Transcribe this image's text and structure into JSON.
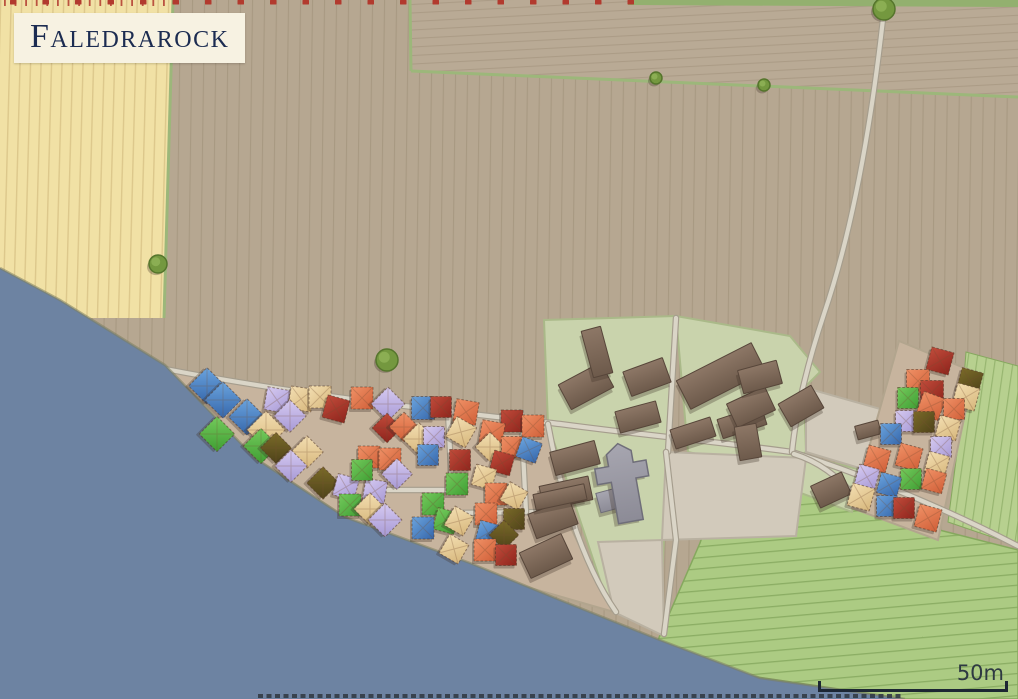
{
  "title": {
    "text": "Faledrarock"
  },
  "scale_bar": {
    "label": "50m"
  },
  "palette": {
    "water": "#6d83a2",
    "shore_edge": "rgba(125,128,95,0.55)",
    "field_brown": "#b6a791",
    "field_brown_line": "#9c8d77",
    "field_brown2": "#b9aa95",
    "field_brown2_line": "#a08f79",
    "field_yellow": "#f1e1a5",
    "field_yellow_line": "#d5bf82",
    "border_green": "#9cb77a",
    "top_strip_green": "#93b06f",
    "field_green": "#accb83",
    "field_green_line": "#85a85e",
    "field_green2": "#b7d08f",
    "field_green2_line": "#8fae68",
    "enclosure": "#c9d3ac",
    "enclosure_edge": "#aab989",
    "bare": "#d2cabb",
    "bare_edge": "#b9b1a1",
    "village_ground": "#c7b49e",
    "village_edge": "#b2a58e",
    "road_fill": "#dad5c7",
    "road_casing": "#a59d8d",
    "barn_light": "#8d7766",
    "barn_dark": "#6d5a4b",
    "barn_edge": "#57463a",
    "gray_light": "#a7a6b0",
    "gray_dark": "#8c8b96",
    "gray_edge": "#6f6e79",
    "shadow": "rgba(58,47,38,0.30)",
    "tick_red": "#b23a2e",
    "dash_dark": "#333b46",
    "scale_color": "#1d2733",
    "scale_text": "#2e3942",
    "title_bg": "#f7f2e2",
    "title_text": "#1c2c51",
    "tree_fill": "#74983f",
    "tree_edge": "#55752c",
    "tree_light": "#8fb257",
    "house_outline": "rgba(80,55,40,0.55)",
    "house_colors": {
      "blue": [
        "#6ba4de",
        "#3566aa"
      ],
      "red": [
        "#c14c3b",
        "#8e241c"
      ],
      "orange": [
        "#f09166",
        "#d05f38"
      ],
      "tan": [
        "#f3deb1",
        "#d7b77c"
      ],
      "green": [
        "#74ca5c",
        "#3f9e33"
      ],
      "lavender": [
        "#d6caf1",
        "#a799d5"
      ],
      "olive": [
        "#7b6b29",
        "#4e4219"
      ]
    }
  },
  "map": {
    "width": 1018,
    "height": 699,
    "fields": {
      "top_right_field": "410,0 1018,0 1018,96 412,72",
      "yellow_field": "0,0 174,0 163,318 0,318",
      "green_field_main": "728,466 800,486 900,520 1018,550 1018,699 905,699 750,676 658,640 700,543 714,502",
      "green_field_east": "966,352 1018,366 1018,546 948,522 960,430",
      "top_green_strip": "628,0 1018,0 1018,7 628,5"
    },
    "borders": [
      "173,0 164,318",
      "410,0 411,71",
      "411,71 1018,97"
    ],
    "enclosures": [
      "544,320 676,316 668,452 662,580 610,610 548,424",
      "676,316 790,336 820,372 804,388 806,452 772,470 688,452",
      "800,455 862,470 852,512 798,492"
    ],
    "bare_plots": [
      "666,452 806,458 796,536 662,540",
      "806,388 884,410 866,470 806,452",
      "598,542 662,540 664,636 614,612"
    ],
    "village_grounds": [
      "155,365 300,394 460,412 548,423 560,505 592,572 614,612 520,585 430,556 345,517 255,458 190,396",
      "899,341 974,372 938,540 852,508"
    ],
    "roads": [
      "M150,366 C300,396 470,414 560,424 C650,436 720,442 792,452 C880,480 962,517 1018,546",
      "M884,10 C872,120 854,226 824,314 C806,368 796,412 792,452",
      "M448,412 L452,490",
      "M378,490 L452,490",
      "M452,513 L548,512",
      "M521,412 L526,512",
      "M548,424 C558,480 580,560 616,612",
      "M676,318 L668,452",
      "M666,452 L676,540 L664,634",
      "M794,454 C820,462 840,478 856,498"
    ],
    "water": "0,268 60,300 165,365 255,458 345,517 470,563 560,600 660,640 760,678 905,699 0,699",
    "shore": "0,268 60,300 165,365 255,458 345,517 470,563 560,600 660,640 760,678 905,699",
    "barns": [
      [
        586,
        386,
        48,
        28,
        -28
      ],
      [
        597,
        352,
        20,
        48,
        -15
      ],
      [
        647,
        377,
        42,
        26,
        -20
      ],
      [
        721,
        376,
        84,
        32,
        -27
      ],
      [
        638,
        417,
        42,
        22,
        -15
      ],
      [
        693,
        433,
        42,
        20,
        -18
      ],
      [
        742,
        422,
        46,
        20,
        -18
      ],
      [
        575,
        458,
        46,
        24,
        -15
      ],
      [
        566,
        493,
        50,
        24,
        -12
      ],
      [
        553,
        519,
        44,
        26,
        -20
      ],
      [
        546,
        556,
        46,
        28,
        -25
      ],
      [
        560,
        497,
        52,
        16,
        -12
      ],
      [
        751,
        407,
        42,
        26,
        -25
      ],
      [
        760,
        377,
        40,
        24,
        -15
      ],
      [
        801,
        406,
        38,
        26,
        -30
      ],
      [
        748,
        442,
        22,
        34,
        -10
      ],
      [
        831,
        490,
        34,
        24,
        -25
      ],
      [
        868,
        430,
        24,
        14,
        -15
      ]
    ],
    "gray_buildings": [
      [
        610,
        500,
        24,
        20,
        -15
      ]
    ],
    "church": {
      "points": "612,522 612,480 598,480 598,464 612,464 612,452 625,443 637,452 637,464 650,464 650,480 637,480 637,522",
      "rotate": [
        -10,
        625,
        485
      ]
    },
    "houses": [
      [
        207,
        386,
        26,
        45,
        "blue"
      ],
      [
        223,
        400,
        26,
        45,
        "blue"
      ],
      [
        247,
        417,
        26,
        45,
        "blue"
      ],
      [
        277,
        400,
        23,
        10,
        "lavender"
      ],
      [
        301,
        399,
        23,
        8,
        "tan"
      ],
      [
        320,
        397,
        22,
        0,
        "tan"
      ],
      [
        336,
        409,
        23,
        15,
        "red"
      ],
      [
        362,
        398,
        22,
        0,
        "orange"
      ],
      [
        388,
        404,
        24,
        45,
        "lavender"
      ],
      [
        423,
        408,
        23,
        0,
        "blue"
      ],
      [
        441,
        407,
        21,
        0,
        "red"
      ],
      [
        466,
        412,
        23,
        10,
        "orange"
      ],
      [
        512,
        421,
        22,
        0,
        "red"
      ],
      [
        533,
        426,
        22,
        0,
        "orange"
      ],
      [
        290,
        416,
        23,
        45,
        "lavender"
      ],
      [
        266,
        430,
        27,
        45,
        "tan"
      ],
      [
        217,
        434,
        25,
        45,
        "green"
      ],
      [
        261,
        446,
        25,
        45,
        "green"
      ],
      [
        387,
        428,
        21,
        45,
        "red"
      ],
      [
        404,
        427,
        21,
        45,
        "orange"
      ],
      [
        419,
        439,
        23,
        45,
        "tan"
      ],
      [
        434,
        437,
        21,
        0,
        "lavender"
      ],
      [
        461,
        432,
        23,
        30,
        "tan"
      ],
      [
        492,
        433,
        23,
        10,
        "orange"
      ],
      [
        490,
        447,
        21,
        45,
        "tan"
      ],
      [
        512,
        447,
        21,
        0,
        "orange"
      ],
      [
        529,
        450,
        21,
        20,
        "blue"
      ],
      [
        428,
        455,
        21,
        0,
        "blue"
      ],
      [
        369,
        457,
        22,
        0,
        "orange"
      ],
      [
        390,
        459,
        22,
        0,
        "orange"
      ],
      [
        460,
        460,
        21,
        0,
        "red"
      ],
      [
        502,
        463,
        21,
        15,
        "red"
      ],
      [
        276,
        448,
        22,
        45,
        "olive"
      ],
      [
        307,
        452,
        23,
        45,
        "tan"
      ],
      [
        291,
        466,
        23,
        45,
        "lavender"
      ],
      [
        323,
        483,
        23,
        45,
        "olive"
      ],
      [
        346,
        487,
        22,
        15,
        "lavender"
      ],
      [
        375,
        491,
        22,
        10,
        "lavender"
      ],
      [
        362,
        470,
        21,
        0,
        "green"
      ],
      [
        350,
        505,
        22,
        0,
        "green"
      ],
      [
        370,
        509,
        23,
        45,
        "tan"
      ],
      [
        385,
        520,
        24,
        45,
        "lavender"
      ],
      [
        397,
        474,
        22,
        45,
        "lavender"
      ],
      [
        484,
        477,
        21,
        15,
        "tan"
      ],
      [
        457,
        484,
        22,
        0,
        "green"
      ],
      [
        496,
        494,
        22,
        0,
        "orange"
      ],
      [
        514,
        496,
        21,
        30,
        "tan"
      ],
      [
        433,
        504,
        22,
        0,
        "green"
      ],
      [
        446,
        521,
        22,
        15,
        "green"
      ],
      [
        459,
        521,
        22,
        30,
        "tan"
      ],
      [
        423,
        528,
        22,
        0,
        "blue"
      ],
      [
        486,
        514,
        22,
        0,
        "orange"
      ],
      [
        514,
        519,
        21,
        0,
        "olive"
      ],
      [
        488,
        533,
        21,
        15,
        "blue"
      ],
      [
        504,
        535,
        21,
        45,
        "olive"
      ],
      [
        454,
        549,
        22,
        30,
        "tan"
      ],
      [
        485,
        550,
        22,
        0,
        "orange"
      ],
      [
        506,
        555,
        21,
        0,
        "red"
      ],
      [
        940,
        361,
        23,
        15,
        "red"
      ],
      [
        918,
        381,
        23,
        0,
        "orange"
      ],
      [
        970,
        381,
        22,
        15,
        "olive"
      ],
      [
        932,
        392,
        23,
        0,
        "red"
      ],
      [
        908,
        398,
        21,
        0,
        "green"
      ],
      [
        966,
        397,
        23,
        15,
        "tan"
      ],
      [
        931,
        406,
        23,
        20,
        "orange"
      ],
      [
        954,
        409,
        21,
        0,
        "orange"
      ],
      [
        906,
        421,
        21,
        0,
        "lavender"
      ],
      [
        924,
        422,
        21,
        0,
        "olive"
      ],
      [
        948,
        428,
        21,
        15,
        "tan"
      ],
      [
        891,
        434,
        21,
        0,
        "blue"
      ],
      [
        941,
        447,
        21,
        0,
        "lavender"
      ],
      [
        877,
        459,
        23,
        15,
        "orange"
      ],
      [
        909,
        457,
        23,
        15,
        "orange"
      ],
      [
        937,
        464,
        21,
        15,
        "tan"
      ],
      [
        867,
        477,
        21,
        15,
        "lavender"
      ],
      [
        911,
        479,
        21,
        0,
        "green"
      ],
      [
        889,
        485,
        21,
        15,
        "blue"
      ],
      [
        934,
        481,
        21,
        15,
        "orange"
      ],
      [
        861,
        497,
        23,
        15,
        "tan"
      ],
      [
        887,
        506,
        21,
        0,
        "blue"
      ],
      [
        904,
        508,
        21,
        0,
        "red"
      ],
      [
        928,
        518,
        23,
        15,
        "orange"
      ]
    ],
    "trees": [
      [
        158,
        264,
        9
      ],
      [
        387,
        360,
        11
      ],
      [
        656,
        78,
        6
      ],
      [
        764,
        85,
        6
      ],
      [
        884,
        9,
        11
      ]
    ],
    "ticks": {
      "y": 0,
      "from": 10,
      "to": 656,
      "step": 32.5,
      "w": 6.5,
      "h": 4.5
    },
    "yellow_ticks": {
      "y": 0,
      "from": 4,
      "to": 171,
      "step": 10.6,
      "w": 1.8,
      "h": 6
    },
    "attribution_dash": {
      "x1": 258,
      "y": 696,
      "x2": 903,
      "w": 4,
      "dash": "5 3.5"
    }
  }
}
